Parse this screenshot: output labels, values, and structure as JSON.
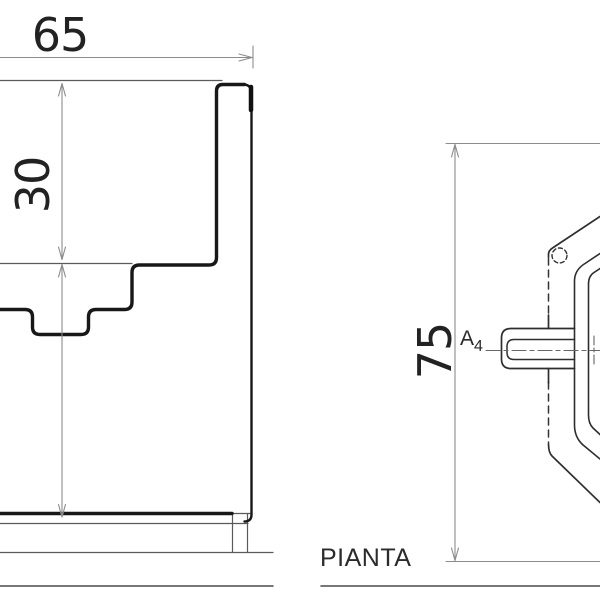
{
  "drawing": {
    "section_view": {
      "width_dim": "65",
      "rim_depth_dim": "30"
    },
    "plan_view": {
      "label": "PIANTA",
      "overall_depth_dim": "75",
      "axis_marker_letter": "A",
      "axis_marker_subscript": "4"
    },
    "colors": {
      "line_dark": "#181818",
      "line_medium": "#2e2e2e",
      "line_thin": "#5a5a5a",
      "dimension_line": "#8c8c8c",
      "text": "#222222",
      "background": "#ffffff"
    }
  }
}
